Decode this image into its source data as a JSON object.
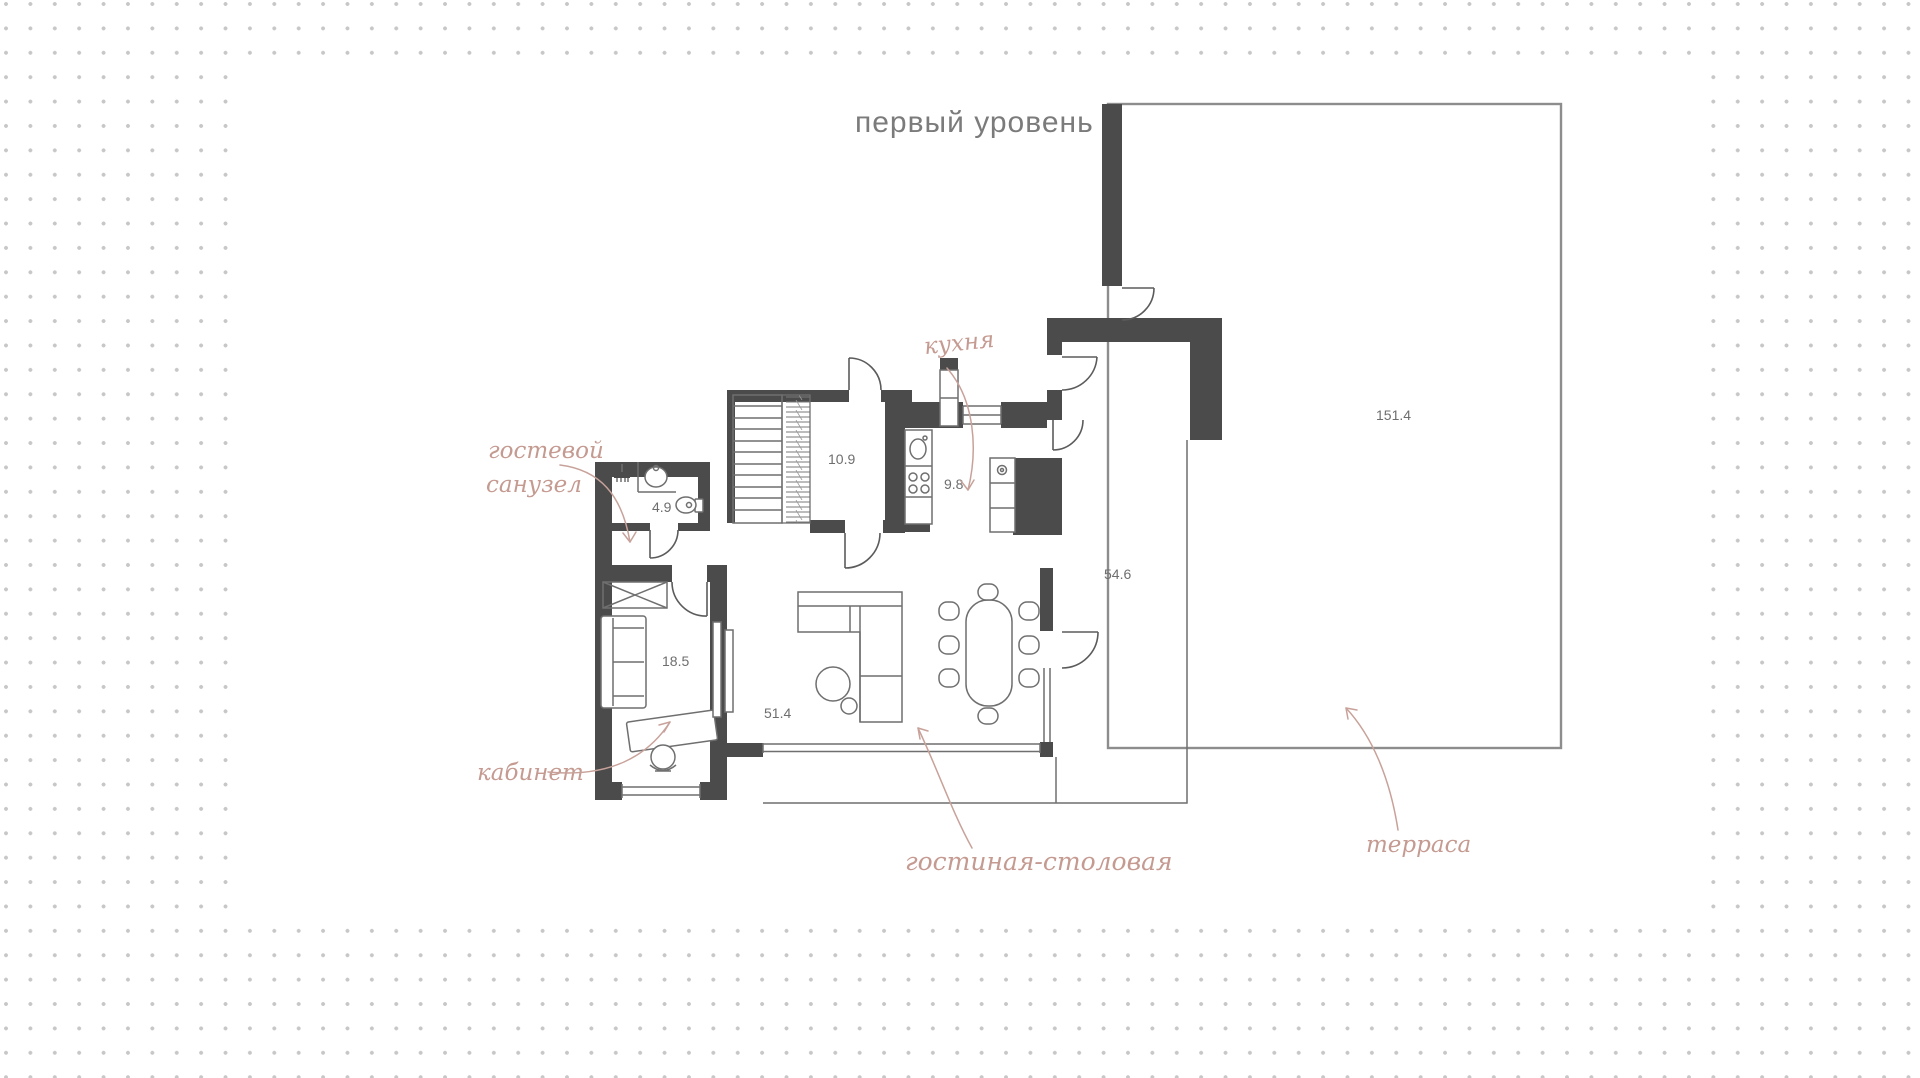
{
  "title": "первый уровень",
  "colors": {
    "wall": "#4b4b4b",
    "thin_line": "#8d8d8d",
    "handwritten_label": "#c49a91",
    "number_text": "#6e6e6e",
    "background_dot": "#c7c7c7"
  },
  "rooms": {
    "guest_wc": {
      "label_line1": "гостевой",
      "label_line2": "санузел",
      "area": "4.9"
    },
    "entry_hall": {
      "area": "10.9"
    },
    "kitchen": {
      "label": "кухня",
      "area": "9.8"
    },
    "office": {
      "label": "кабинет",
      "area": "18.5"
    },
    "living_dining": {
      "label": "гостиная-столовая",
      "area": "51.4"
    },
    "hall_zone": {
      "area": "54.6"
    },
    "terrace": {
      "label": "терраса",
      "area": "151.4"
    }
  }
}
